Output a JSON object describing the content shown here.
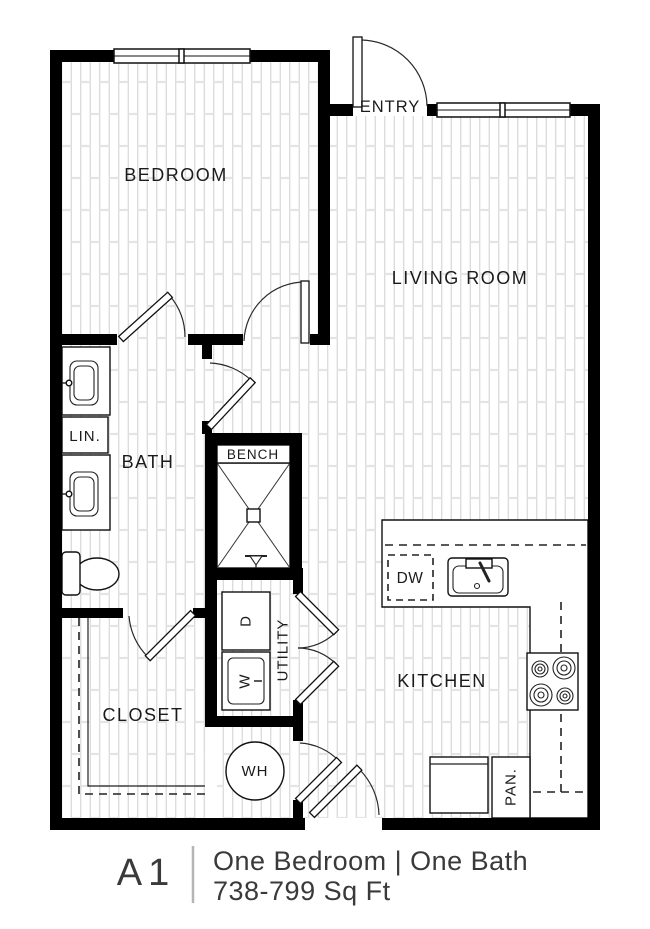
{
  "floor_plan": {
    "rooms": {
      "bedroom": "BEDROOM",
      "entry": "ENTRY",
      "living_room": "LIVING ROOM",
      "bath": "BATH",
      "linen_closet": "LIN.",
      "shower_bench": "BENCH",
      "closet": "CLOSET",
      "utility": "UTILITY",
      "kitchen": "KITCHEN"
    },
    "appliances": {
      "dryer": "D",
      "washer": "W",
      "water_heater": "WH",
      "dishwasher": "DW",
      "pantry": "PAN."
    }
  },
  "caption": {
    "plan_code": "A1",
    "beds_baths": "One Bedroom | One Bath",
    "square_feet": "738-799 Sq Ft"
  },
  "colors": {
    "wall": "#000000",
    "floor_line": "#d4d4d4",
    "floor_tick": "#e4e4e4",
    "label_text": "#1b1b1b",
    "caption_text": "#3a3a3a",
    "caption_divider": "#b5b5b5",
    "background": "#ffffff"
  }
}
